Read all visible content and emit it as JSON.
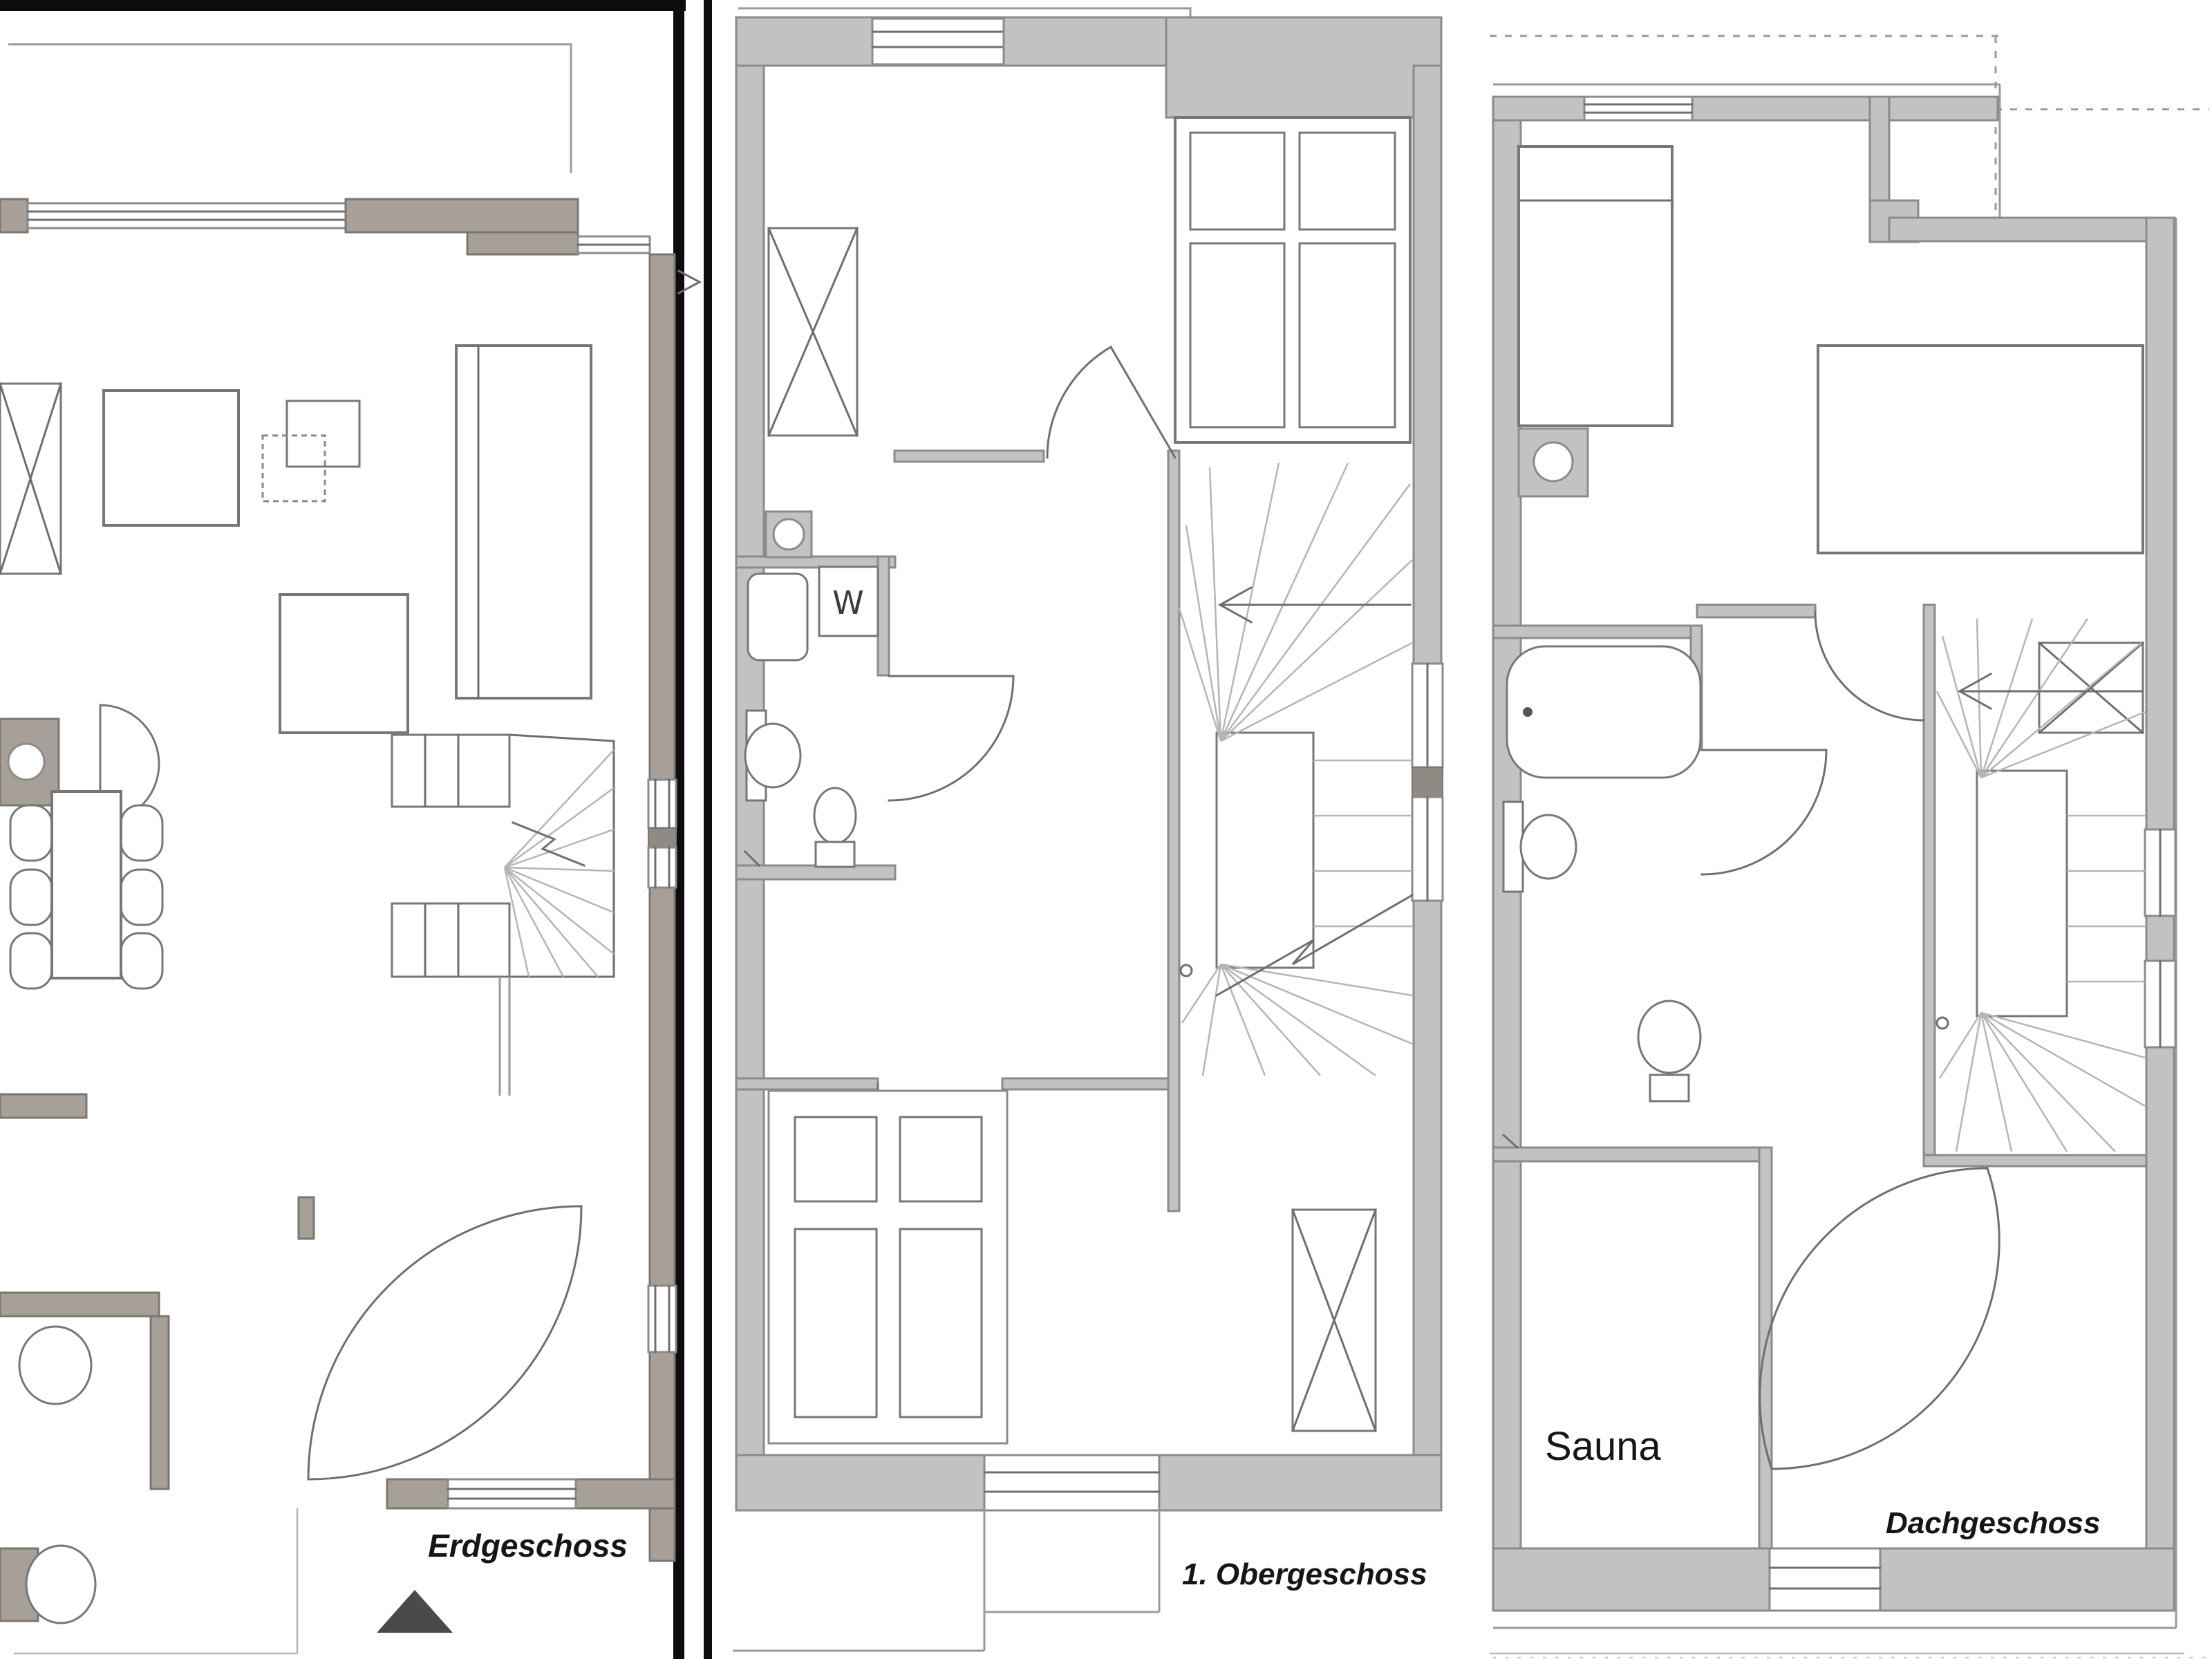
{
  "document_type": "floor-plan-sheet",
  "labels": {
    "erdgeschoss": "Erdgeschoss",
    "obergeschoss": "1. Obergeschoss",
    "dachgeschoss": "Dachgeschoss",
    "sauna": "Sauna",
    "washer": "W"
  },
  "colors": {
    "wall_warm": "#a6a099",
    "wall_warm_edge": "#7d766f",
    "wall_gray": "#c3c2c1",
    "wall_dark": "#8f8a84",
    "line": "#6f6f6f",
    "line_light": "#9a9a9a",
    "black": "#0d0d0d",
    "text": "#161616"
  }
}
